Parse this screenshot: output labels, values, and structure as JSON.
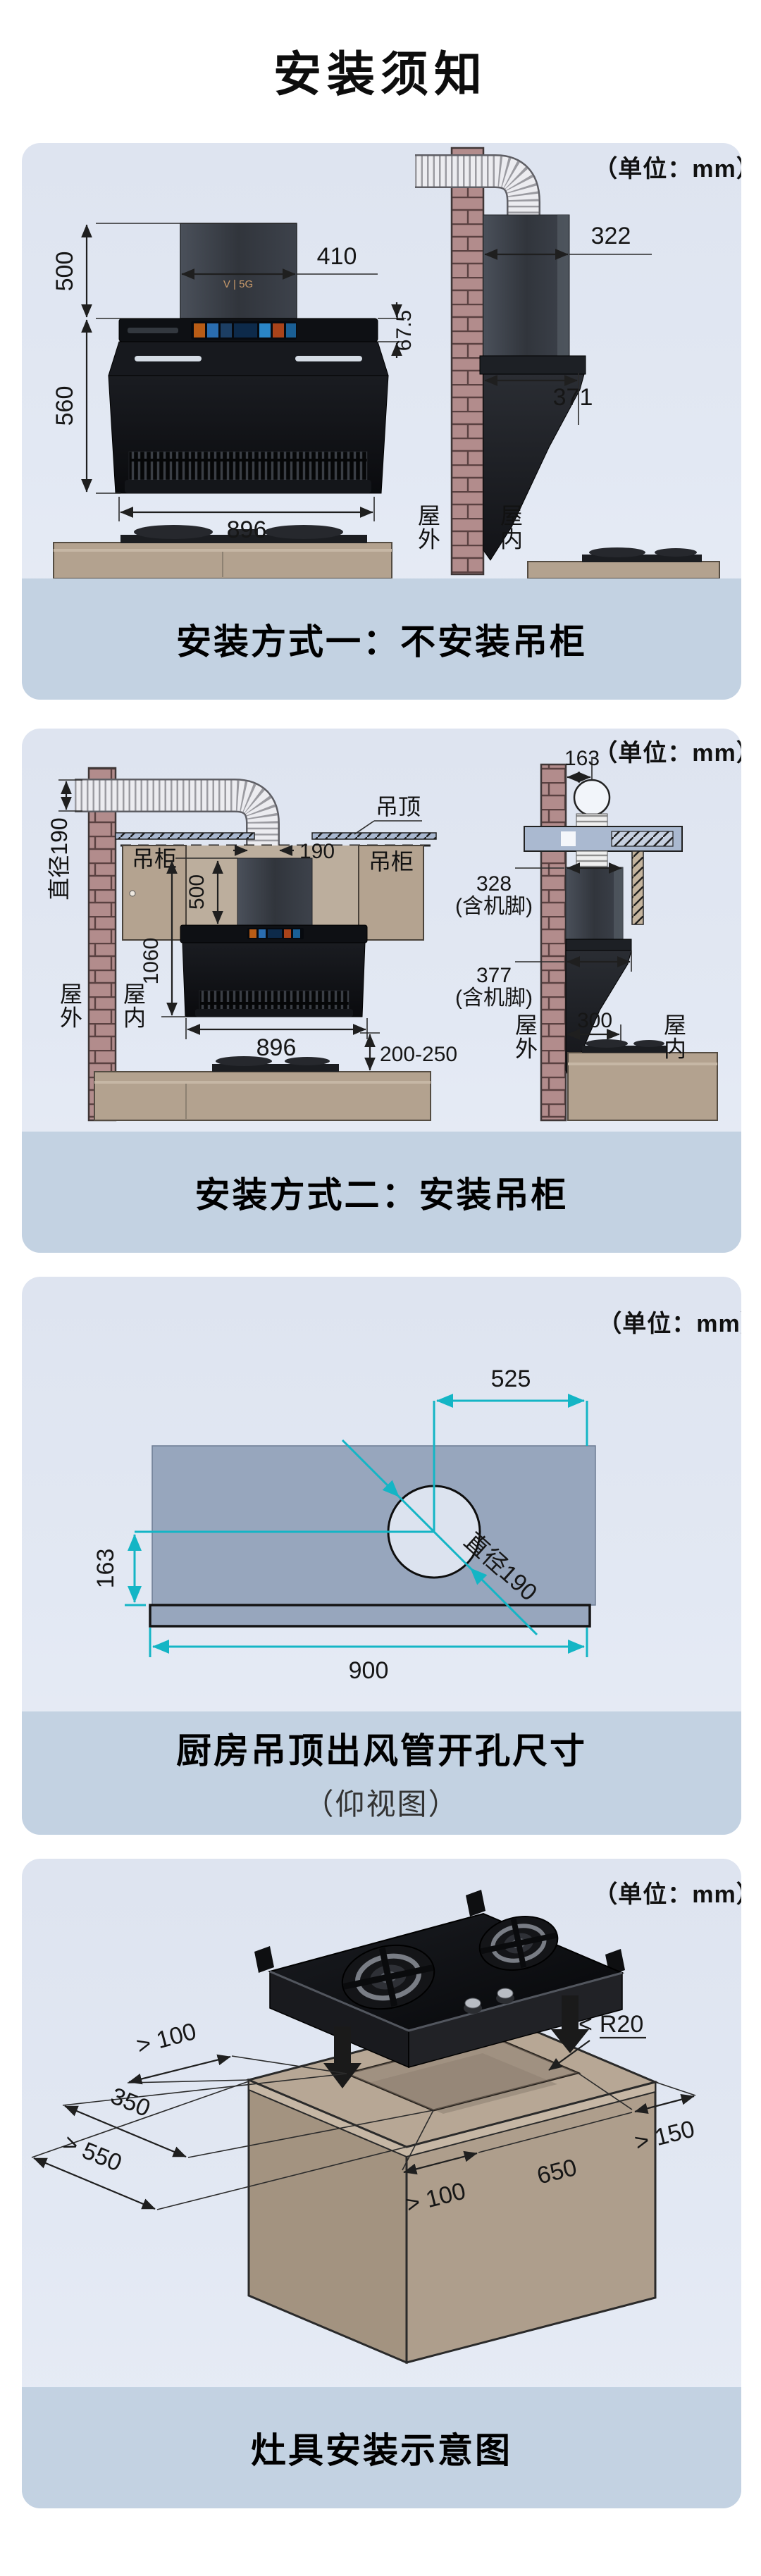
{
  "page": {
    "title": "安装须知"
  },
  "colors": {
    "panel_bg": "#e2e8f3",
    "caption_bg": "#c3d2e2",
    "dim_cyan": "#14b5c5",
    "brick": "#b28c8c",
    "counter_wood": "#b3a28f",
    "ceiling_board": "#97a6bd",
    "hood_black": "#0b0c0f",
    "logo_copper": "#c89a6b"
  },
  "panel1": {
    "unit": "（单位：mm）",
    "caption": "安装方式一：不安装吊柜",
    "front": {
      "logo": "V | 5G",
      "chimney_height": "500",
      "chimney_width": "410",
      "panel_height": "67.5",
      "body_height": "560",
      "width": "896"
    },
    "side": {
      "top_depth": "322",
      "bottom_depth": "371",
      "outside": "屋外",
      "inside": "屋内"
    }
  },
  "panel2": {
    "unit": "（单位：mm）",
    "caption": "安装方式二：安装吊柜",
    "left": {
      "duct_dia": "直径190",
      "ceiling": "吊顶",
      "cabinet_left": "吊柜",
      "cabinet_right": "吊柜",
      "duct_width": "190",
      "chimney_height": "500",
      "install_height": "1060",
      "width": "896",
      "hood_to_counter": "200-250",
      "outside": "屋外",
      "inside": "屋内"
    },
    "right": {
      "wall_to_duct": "163",
      "top_depth": "328",
      "top_depth_note": "(含机脚)",
      "bottom_depth": "377",
      "bottom_depth_note": "(含机脚)",
      "wall_to_stove": "300",
      "outside": "屋外",
      "inside": "屋内"
    }
  },
  "panel3": {
    "unit": "（单位：mm）",
    "caption": "厨房吊顶出风管开孔尺寸",
    "subcaption": "（仰视图）",
    "right_offset": "525",
    "bottom_offset": "163",
    "hole_dia": "直径190",
    "panel_width": "900"
  },
  "panel4": {
    "unit": "（单位：mm）",
    "caption": "灶具安装示意图",
    "corner_lt": "<",
    "corner_radius": "R20",
    "back_clearance": "> 100",
    "cutout_depth": "350",
    "counter_depth": "> 550",
    "front_clearance": "> 100",
    "cutout_width": "650",
    "side_clearance": "> 150"
  }
}
